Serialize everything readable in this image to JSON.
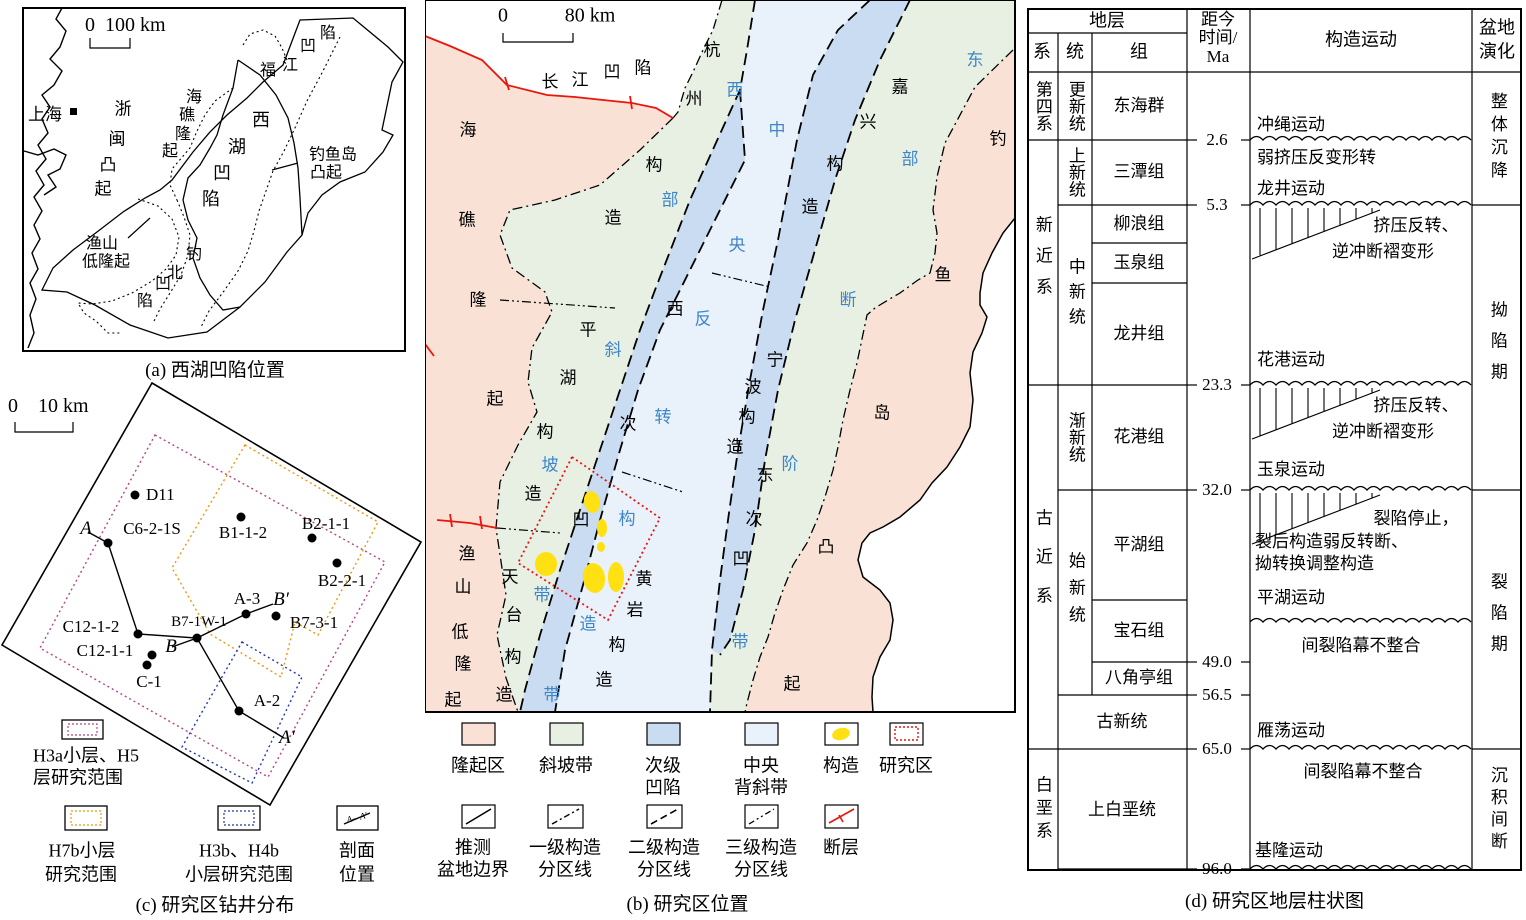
{
  "colors": {
    "uplift": "#f9e2d5",
    "slope": "#e7f0e3",
    "sag": "#c9dcf2",
    "anticline": "#e9f2fa",
    "structure": "#ffe013",
    "fault": "#e8160c",
    "study": "#ee1111",
    "h3a": "#b5458a",
    "h7b": "#f2960a",
    "h3b": "#2636b0",
    "blue_text": "#3f86c9"
  },
  "panel_a": {
    "scale": "0  100 km",
    "labels": {
      "shanghai": "上海",
      "zhemin": "浙闽凸起",
      "haijiao": "海礁隆起",
      "fujiang": "福江凹陷",
      "xihu": "西湖凹陷",
      "diaoyu1": "钓鱼岛",
      "diaoyu2": "凸起",
      "yushan1": "渔山",
      "yushan2": "低隆起",
      "diaobei": "钓北凹陷"
    },
    "caption": "(a) 西湖凹陷位置"
  },
  "panel_c": {
    "scale": "0    10 km",
    "wells": [
      "D11",
      "C6-2-1S",
      "B1-1-2",
      "B2-1-1",
      "B2-2-1",
      "A-3",
      "B7-3-1",
      "B7-1W-1",
      "C12-1-2",
      "C12-1-1",
      "C-1",
      "A-2"
    ],
    "sections": {
      "a": "A",
      "ap": "A′",
      "b": "B",
      "bp": "B′",
      "sym": "A—A′"
    },
    "legend": [
      {
        "line1": "H3a小层、H5",
        "line2": "层研究范围"
      },
      {
        "line1": "H7b小层",
        "line2": "研究范围"
      },
      {
        "line1": "H3b、H4b",
        "line2": "小层研究范围"
      },
      {
        "line1": "剖面",
        "line2": "位置"
      }
    ],
    "caption": "(c) 研究区钻井分布"
  },
  "panel_b": {
    "scale0": "0",
    "scale80": "80 km",
    "map_labels": {
      "changjiang": "长江凹陷",
      "hangzhou": "杭州构造",
      "jiaxing": "嘉兴构造",
      "haijiao": "海礁隆起",
      "pinghu": "平湖构造",
      "xiciao": "西次凹",
      "ningbo": "宁波构造",
      "dongciao": "东次凹",
      "huangyan": "黄岩构造",
      "tiantai": "天台构造",
      "yushan": "渔山低隆起",
      "diaoyudao": "钓鱼岛凸起"
    },
    "belt_labels": {
      "west": "西部斜坡带",
      "central": "中央反转构造带",
      "east": "东部断阶带"
    },
    "legend_fill": [
      {
        "line1": "隆起区",
        "line2": ""
      },
      {
        "line1": "斜坡带",
        "line2": ""
      },
      {
        "line1": "次级",
        "line2": "凹陷"
      },
      {
        "line1": "中央",
        "line2": "背斜带"
      },
      {
        "line1": "构造",
        "line2": ""
      },
      {
        "line1": "研究区",
        "line2": ""
      }
    ],
    "legend_line": [
      {
        "line1": "推测",
        "line2": "盆地边界"
      },
      {
        "line1": "一级构造",
        "line2": "分区线"
      },
      {
        "line1": "二级构造",
        "line2": "分区线"
      },
      {
        "line1": "三级构造",
        "line2": "分区线"
      },
      {
        "line1": "断层",
        "line2": ""
      }
    ],
    "caption": "(b) 研究区位置"
  },
  "panel_d": {
    "header": {
      "strata": "地层",
      "sys": "系",
      "ser": "统",
      "fm": "组",
      "age1": "距今",
      "age2": "时间/",
      "age3": "Ma",
      "tect": "构造运动",
      "basin1": "盆地",
      "basin2": "演化"
    },
    "systems": {
      "q": "第四系",
      "n": "新近系",
      "e": "古近系",
      "k": "白垩系"
    },
    "series": {
      "pleist": "更新统",
      "plio": "上新统",
      "mio": "中新统",
      "oligo": "渐新统",
      "eo": "始新统"
    },
    "formations": {
      "donghai": "东海群",
      "santan": "三潭组",
      "liulang": "柳浪组",
      "yuquan": "玉泉组",
      "longjing": "龙井组",
      "huagang": "花港组",
      "pinghu": "平湖组",
      "baoshi": "宝石组",
      "bajiaoting": "八角亭组",
      "guxin": "古新统",
      "shangbai": "上白垩统"
    },
    "ages": {
      "a1": "2.6",
      "a2": "5.3",
      "a3": "23.3",
      "a4": "32.0",
      "a5": "49.0",
      "a6": "56.5",
      "a7": "65.0",
      "a8": "96.0"
    },
    "movements": {
      "okinawa": "冲绳运动",
      "weak": "弱挤压反变形转",
      "longjing": "龙井运动",
      "squeeze1": "挤压反转、",
      "squeeze2": "逆冲断褶变形",
      "huagang": "花港运动",
      "yuquan": "玉泉运动",
      "riftstop": "裂陷停止，",
      "riftpost": "裂后构造弱反转断、",
      "riftadj": "拗转换调整构造",
      "pinghu": "平湖运动",
      "unconf": "间裂陷幕不整合",
      "yandang": "雁荡运动",
      "jilong": "基隆运动"
    },
    "evolution": {
      "subside": "整体沉降",
      "depress": "拗陷期",
      "rift": "裂陷期",
      "hiatus": "沉积间断"
    },
    "caption": "(d) 研究区地层柱状图"
  }
}
